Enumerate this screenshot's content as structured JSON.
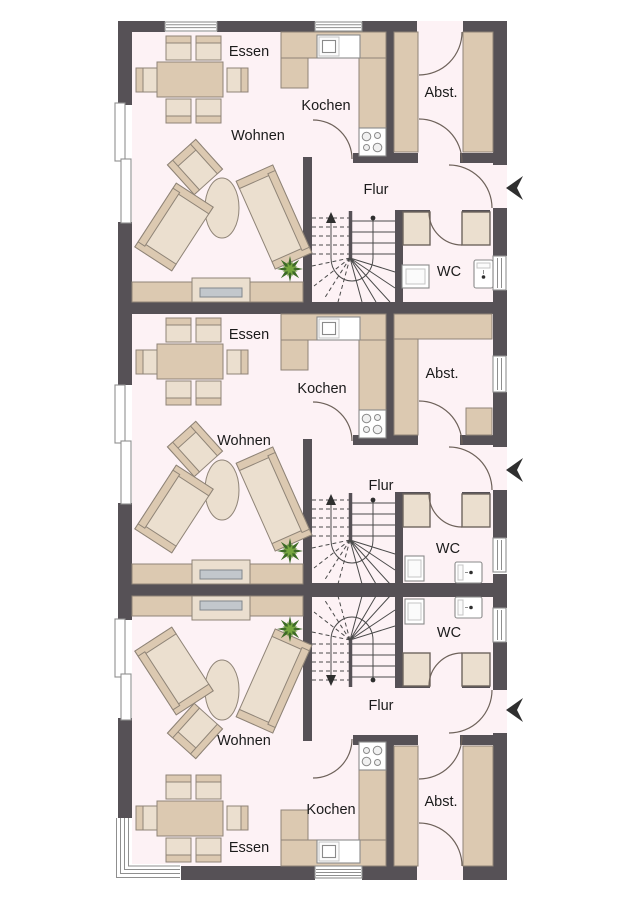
{
  "plan": {
    "type": "apartment-floor-plan",
    "colors": {
      "wall": "#565156",
      "floor": "#fdf2f5",
      "furn_mid": "#dcc9b1",
      "furn_light": "#ebdfcf",
      "furn_border": "#8f8477",
      "cab_border": "#6e655e",
      "fixture_border": "#8a8a8a",
      "window_frame": "#8f8f8f",
      "arc_color": "#6e625a",
      "stair_line": "#4a4a4a",
      "mark_dark": "#2f2f2f",
      "screen_gray": "#c2c7cc",
      "plant_dark": "#3e6b27",
      "plant_light": "#76a63f"
    },
    "units": [
      {
        "labels": {
          "essen": "Essen",
          "kochen": "Kochen",
          "wohnen": "Wohnen",
          "abst": "Abst.",
          "flur": "Flur",
          "wc": "WC"
        }
      },
      {
        "labels": {
          "essen": "Essen",
          "kochen": "Kochen",
          "wohnen": "Wohnen",
          "abst": "Abst.",
          "flur": "Flur",
          "wc": "WC"
        }
      },
      {
        "labels": {
          "essen": "Essen",
          "kochen": "Kochen",
          "wohnen": "Wohnen",
          "abst": "Abst.",
          "flur": "Flur",
          "wc": "WC"
        }
      }
    ],
    "icons": {
      "entrance_arrow": "left-arrowhead",
      "stair_direction_marker": "up-arrow-and-dot",
      "plant": "star-foliage",
      "stove": "four-burner-cooktop",
      "sink": "square-basin"
    }
  }
}
